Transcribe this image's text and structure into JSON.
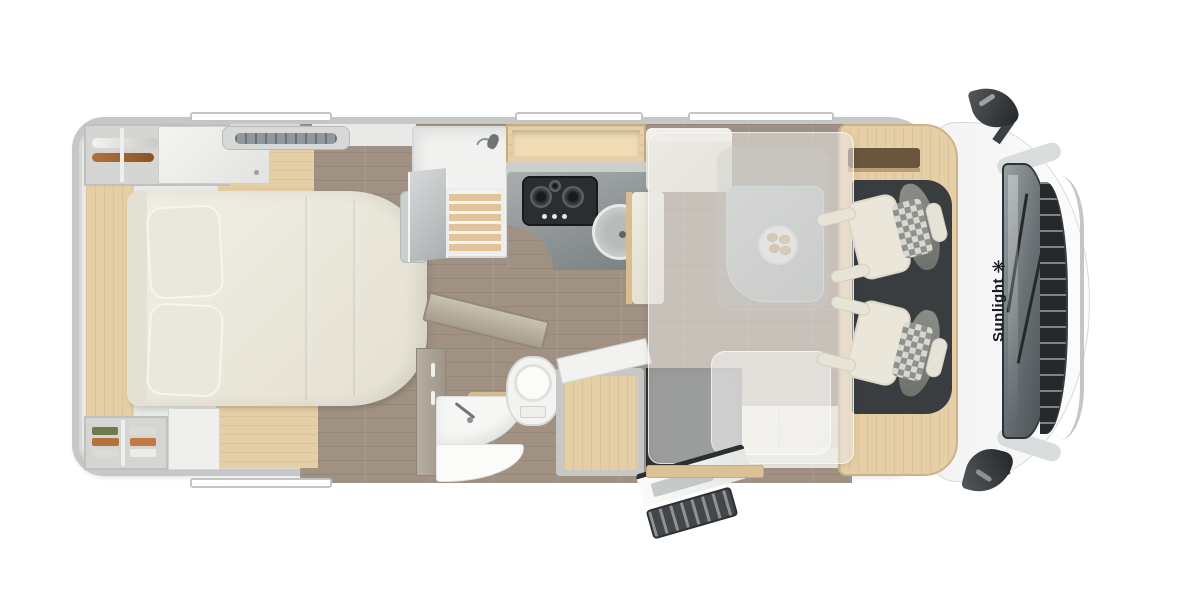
{
  "brand": {
    "name": "Sunlight",
    "icon": "eight-spoke-sun"
  },
  "colors": {
    "wall": "#c6c8c7",
    "wall_inner": "#e8e9e7",
    "body_white": "#f4f5f4",
    "floor": "#a09183",
    "wood": "#e6cfa6",
    "wood_deep": "#d9bc92",
    "bed": "#ede9dd",
    "cream": "#e9e5d8",
    "counter": "#96999b",
    "hob": "#2b2e30",
    "dark_floor": "#3a3d3f",
    "glass": "#5d6468",
    "grille": "#26292c",
    "logo": "#161b23",
    "clothes_orange": "#b2713d",
    "clothes_green": "#6d7b4f",
    "table": "#b3b7b6"
  },
  "fixtures": [
    {
      "name": "rear-wardrobe"
    },
    {
      "name": "hanging-clothes"
    },
    {
      "name": "overhead-locker-door"
    },
    {
      "name": "roof-vent"
    },
    {
      "name": "island-bed"
    },
    {
      "name": "pillows"
    },
    {
      "name": "bedside-shelf"
    },
    {
      "name": "clothes-shelves"
    },
    {
      "name": "drawer-front"
    },
    {
      "name": "shower-cabin"
    },
    {
      "name": "shower-tray"
    },
    {
      "name": "shower-head"
    },
    {
      "name": "kitchen-overhead-cabinet"
    },
    {
      "name": "kitchen-counter"
    },
    {
      "name": "gas-hob-3-burner"
    },
    {
      "name": "round-sink"
    },
    {
      "name": "dinette-top-bench"
    },
    {
      "name": "dinette-side-bench"
    },
    {
      "name": "dinette-table"
    },
    {
      "name": "breakfast-plate"
    },
    {
      "name": "dinette-bottom-bench"
    },
    {
      "name": "drop-down-bed-overlay"
    },
    {
      "name": "bathroom-vanity"
    },
    {
      "name": "corner-washbasin"
    },
    {
      "name": "toilet"
    },
    {
      "name": "bathroom-door-open"
    },
    {
      "name": "entry-step-box"
    },
    {
      "name": "entry-door-open"
    },
    {
      "name": "entry-exterior-step"
    },
    {
      "name": "entry-threshold"
    },
    {
      "name": "cab-wood-surround"
    },
    {
      "name": "cab-floor"
    },
    {
      "name": "cab-seat-top"
    },
    {
      "name": "cab-seat-bottom"
    },
    {
      "name": "windshield"
    },
    {
      "name": "wipers"
    },
    {
      "name": "front-grille"
    },
    {
      "name": "front-bumper-chrome"
    },
    {
      "name": "side-mirror-top"
    },
    {
      "name": "side-mirror-bottom"
    },
    {
      "name": "wall-window-slots"
    }
  ]
}
